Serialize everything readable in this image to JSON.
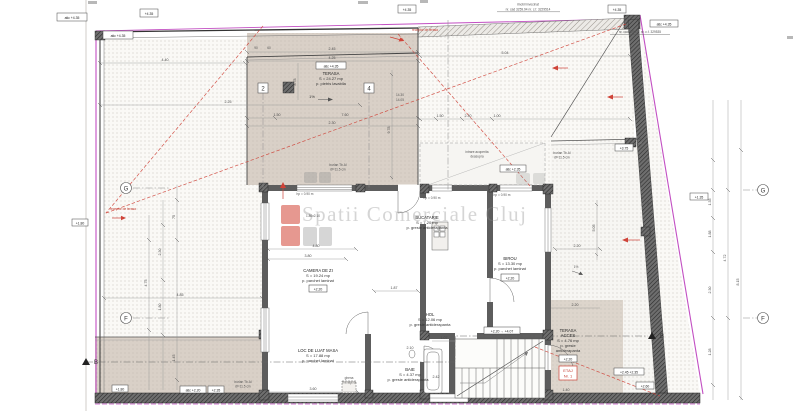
{
  "watermark": {
    "brand": "Spatii Comerciale Cluj"
  },
  "rooms": {
    "terasa": {
      "name": "TERASA",
      "area": "S = 24.27 mp",
      "finish": "p. pietris lavabila",
      "atic": "atic +4.35",
      "slope": "1%"
    },
    "camera": {
      "name": "CAMERA DE ZI",
      "area": "S = 19.24 mp",
      "finish": "p. parchet laminat",
      "level": "+2.20"
    },
    "locmasa": {
      "name": "LOC DE LUAT MASA",
      "area": "S = 17.88 mp",
      "finish": "p. parchet laminat"
    },
    "bucatarie": {
      "name": "BUCATARIE",
      "area": "S = 7.20 mp",
      "finish": "p. gresie antiderapanta"
    },
    "birou": {
      "name": "BIROU",
      "area": "S = 13.30 mp",
      "finish": "p. parchet laminat",
      "level": "+2.20"
    },
    "hol": {
      "name": "HOL",
      "area": "S = 12.06 mp",
      "finish": "p. gresie antiderapanta"
    },
    "baie": {
      "name": "BAIE",
      "area": "S = 4.37 mp",
      "finish": "p. gresie antiderapanta"
    },
    "acces": {
      "name": "TERASA",
      "name2": "ACCES",
      "area": "S = 4.76 mp",
      "finish": "p. gresie",
      "finish2": "antiderapanta",
      "level": "+2.20",
      "tag1": "ETAJ",
      "tag2": "Nr. 1"
    }
  },
  "levels": {
    "e1": "atic +4.35",
    "e2": "+4.35",
    "e3": "atic +4.35",
    "e4": "+4.35",
    "e5": "+4.35",
    "e7": "+1.80",
    "e8": "+1.80",
    "e9": "atic +2.20",
    "e10": "+2.35",
    "e11": "atic +2.35",
    "e12": "+3.75",
    "e13": "+1.35",
    "e14": "+2.45 +2.35",
    "e15": "+2.60",
    "e16": "+2.20 → +4.07"
  },
  "notes": {
    "receptor": "receptor de terasa",
    "burlan1": "burlan Tb.Al",
    "burlan2": "Ø=11.5 cm",
    "ghena1": "ghena",
    "ghena2": "menajera",
    "intrare1": "intrare acoperita",
    "intrare2": "deasupra",
    "tigla": "tigla",
    "hp": "hp = 0.90 m",
    "win": "1.80x2.10",
    "nb_top1": "imobil invecinat",
    "nb_top2": "nr. cad 3259.94 nr. c.f. 3229514",
    "nb_right": "nr. cad 325427 nr. c.f. 329535",
    "slope": "1%"
  },
  "grid": {
    "g": "G",
    "f": "F",
    "c2": "2",
    "c4": "4",
    "b": "B"
  },
  "dims": {
    "d01": "4.40",
    "d02": "2.45",
    "d03": "4.25",
    "d04": "5.04",
    "d05": "2.25",
    "d06": "1.50",
    "d07": "7.60",
    "d08": "2.30",
    "d09": "90",
    "d10": "60",
    "d11": "1.50",
    "d12": "2.30",
    "d13": "1.00",
    "d14": "8.78",
    "d15": "9.78",
    "d16": "4.80",
    "d17": "3.80",
    "d18": "1.87",
    "d19": "1.07",
    "d20": "2.10",
    "d21": "2.42",
    "d22": "3.60",
    "d23": "1.40",
    "d24": "1.45",
    "d25": "2.20",
    "d26": "2.20",
    "d27": "4.85",
    "d28": "5.05",
    "d29": "4.75",
    "d30": "2.30",
    "d31": "1.80",
    "d32": "75",
    "d33": "1.45",
    "d34": "1.35",
    "d35": "1.88",
    "d36": "2.30",
    "d37": "4.72",
    "d38": "8.15",
    "d39": "1.28",
    "d40": "14.30",
    "d41": "14.05"
  }
}
